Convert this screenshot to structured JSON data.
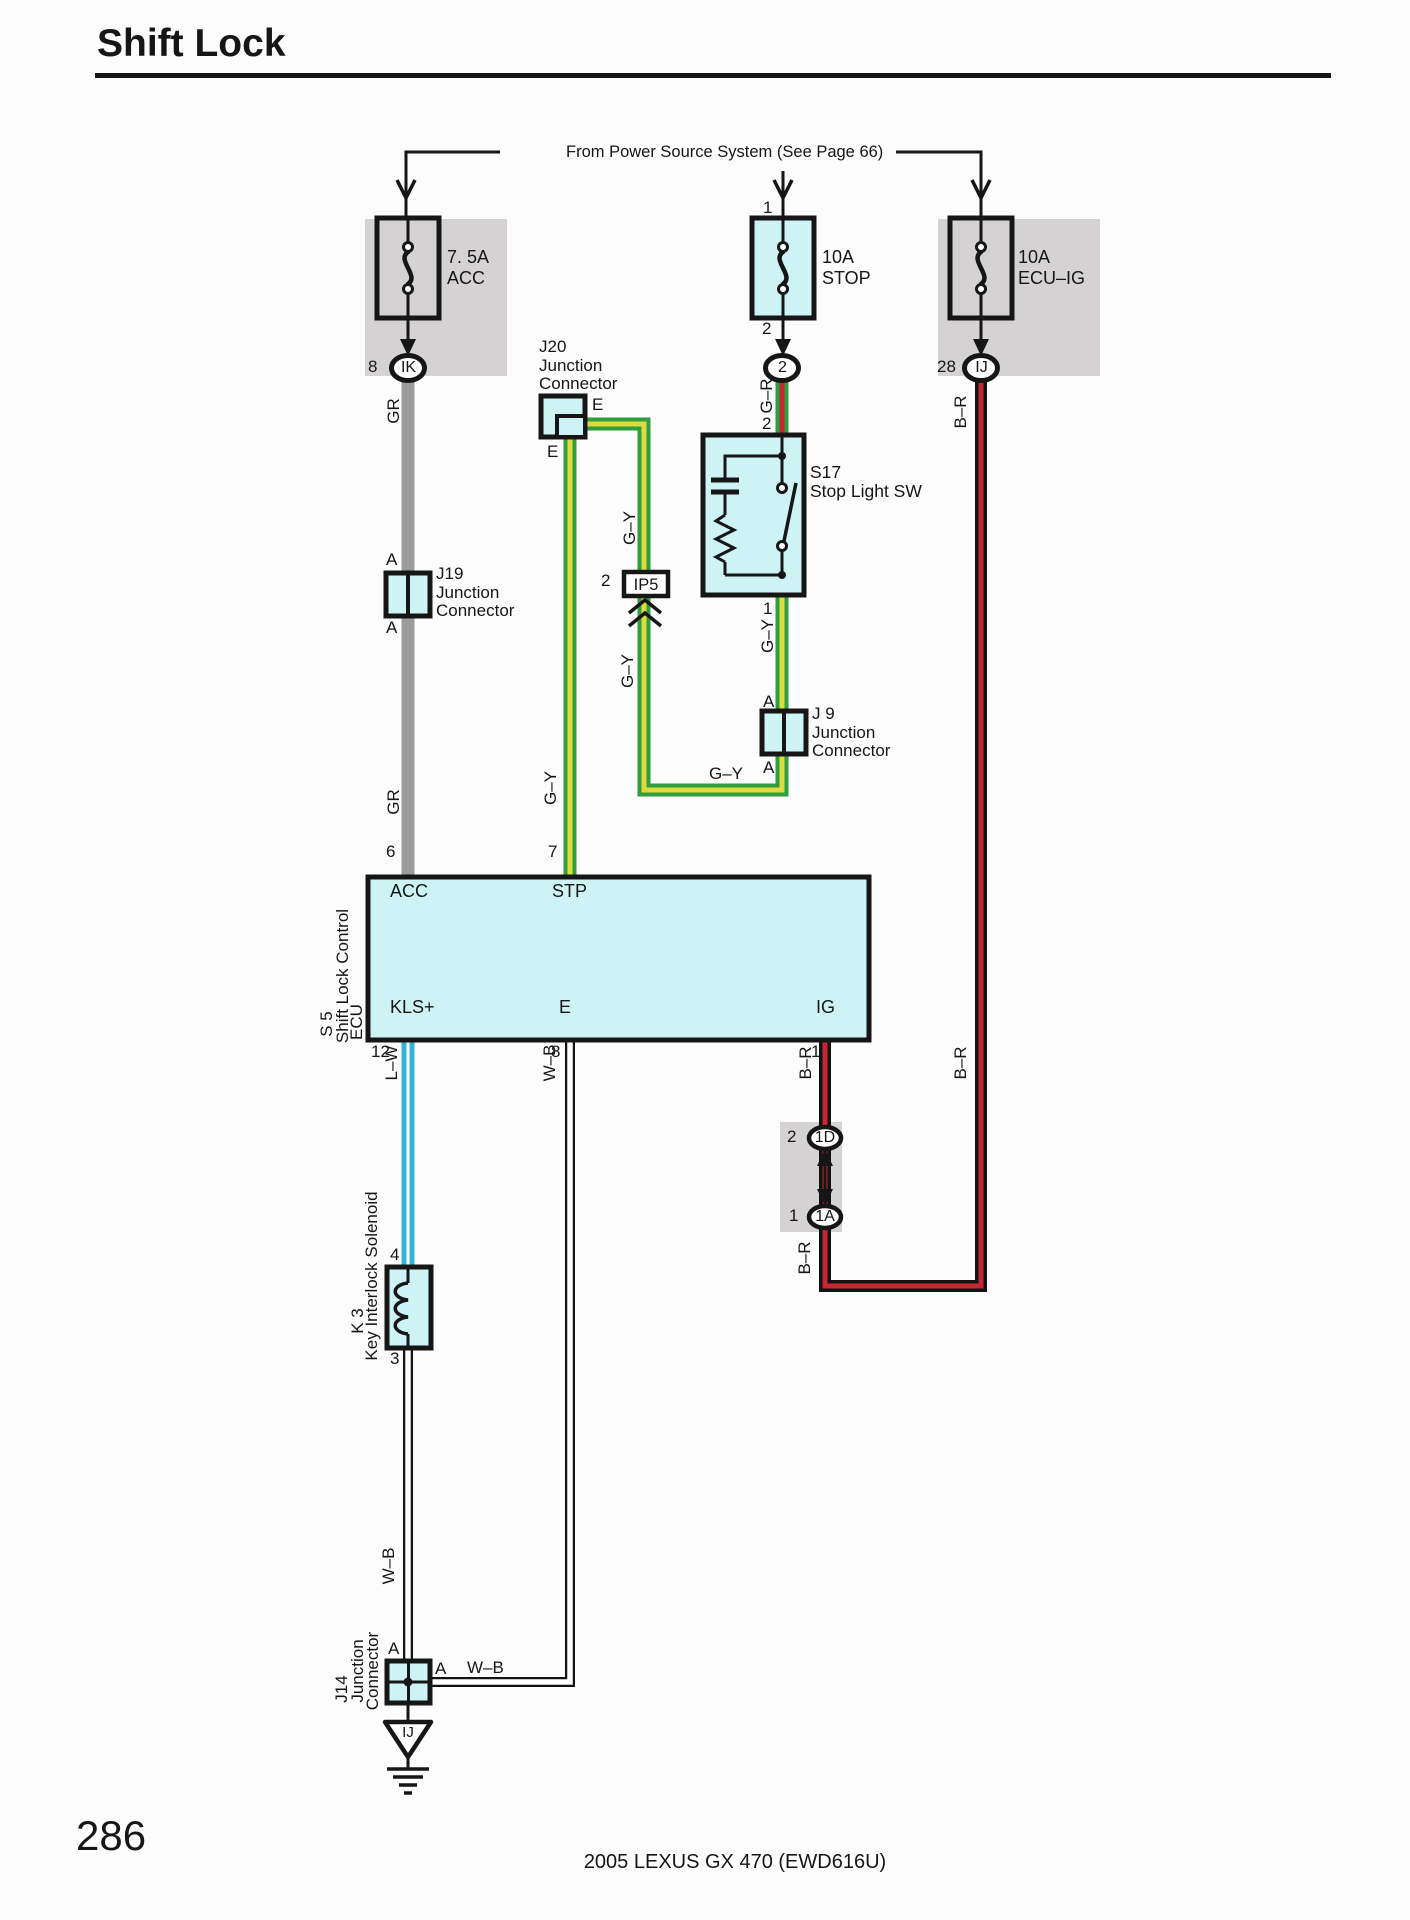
{
  "page": {
    "title": "Shift Lock",
    "number": "286",
    "footer": "2005 LEXUS GX 470 (EWD616U)",
    "power_note": "From Power Source System (See Page 66)"
  },
  "colors": {
    "ink": "#161616",
    "component_fill": "#cdf3f4",
    "panel_gray": "#d4d2d2",
    "wire_green": "#2f9e40",
    "wire_yellow": "#e0da3c",
    "wire_red": "#c52734",
    "wire_blue": "#35b1d5",
    "wire_gray": "#9b9b9b"
  },
  "fuses": {
    "acc": {
      "rating": "7. 5A",
      "name": "ACC",
      "pin_out": "8",
      "connector": "IK"
    },
    "stop": {
      "rating": "10A",
      "name": "STOP",
      "pin_in": "1",
      "pin_out": "2",
      "connector": "2"
    },
    "ecu_ig": {
      "rating": "10A",
      "name": "ECU–IG",
      "pin_out": "28",
      "connector": "IJ"
    }
  },
  "junctions": {
    "j20": {
      "id": "J20",
      "line1": "Junction",
      "line2": "Connector",
      "pin_right": "E",
      "pin_down": "E"
    },
    "j19": {
      "id": "J19",
      "line1": "Junction",
      "line2": "Connector",
      "pin_top": "A",
      "pin_bottom": "A"
    },
    "j9": {
      "id": "J 9",
      "line1": "Junction",
      "line2": "Connector",
      "pin_top": "A",
      "pin_bottom": "A"
    },
    "j14": {
      "id": "J14",
      "line1": "Junction",
      "line2": "Connector",
      "pin_top": "A",
      "pin_right": "A"
    }
  },
  "components": {
    "s17": {
      "id": "S17",
      "name": "Stop Light SW",
      "pin_top": "2",
      "pin_bottom": "1"
    },
    "s5": {
      "id": "S 5",
      "name": "Shift Lock Control",
      "name2": "ECU",
      "pin_acc": "ACC",
      "pin_acc_num": "6",
      "pin_stp": "STP",
      "pin_stp_num": "7",
      "pin_kls": "KLS+",
      "pin_kls_num": "12",
      "pin_e": "E",
      "pin_e_num": "8",
      "pin_ig": "IG",
      "pin_ig_num": "1"
    },
    "k3": {
      "id": "K 3",
      "name": "Key Interlock Solenoid",
      "pin_top": "4",
      "pin_bottom": "3"
    },
    "ip5": {
      "id": "IP5",
      "pin": "2"
    },
    "t1d": {
      "pin": "2",
      "label": "1D"
    },
    "t1a": {
      "pin": "1",
      "label": "1A"
    },
    "ground": {
      "label": "IJ"
    }
  },
  "wire_labels": {
    "gr_upper": "GR",
    "gr_lower": "GR",
    "g_r": "G–R",
    "gy_branch_upper": "G–Y",
    "gy_branch_lower": "G–Y",
    "gy_s17": "G–Y",
    "gy_horizontal": "G–Y",
    "gy_stp": "G–Y",
    "b_r_fuse": "B–R",
    "b_r_ig": "B–R",
    "b_r_right": "B–R",
    "b_r_1a": "B–R",
    "l_w": "L–W",
    "w_b_e": "W–B",
    "w_b_solenoid": "W–B",
    "w_b_j14": "W–B"
  }
}
